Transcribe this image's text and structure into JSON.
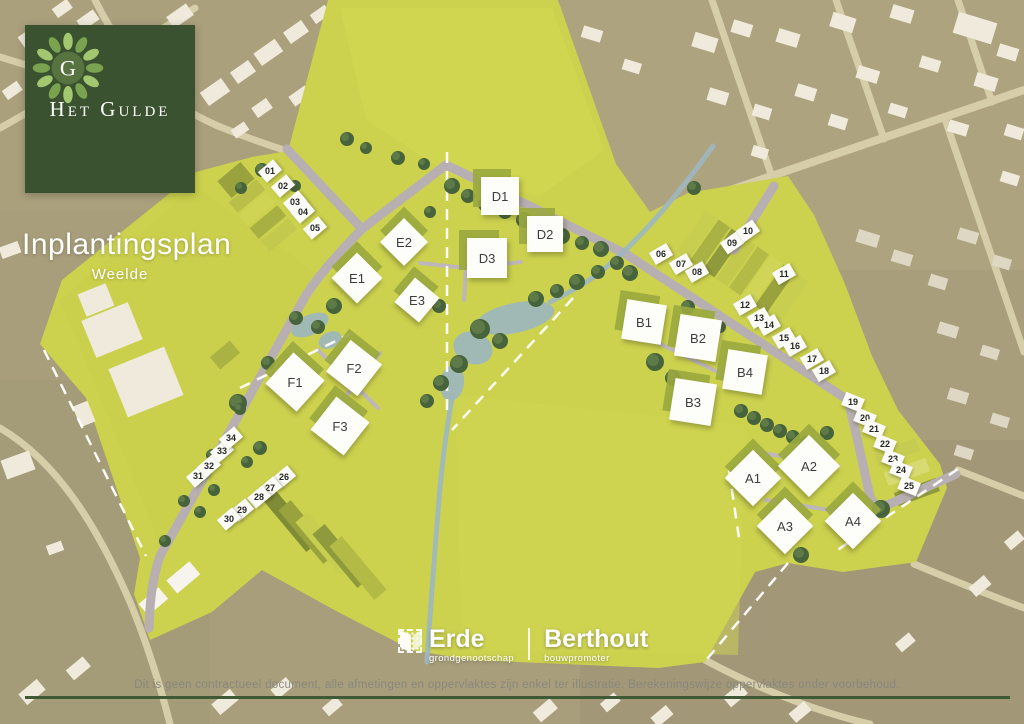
{
  "brand": {
    "monogram": "G",
    "name": "Het Gulde"
  },
  "title": {
    "main": "Inplantingsplan",
    "sub": "Weelde"
  },
  "partners": {
    "erde": {
      "name": "Erde",
      "tagline": "grondgenootschap"
    },
    "berthout": {
      "name": "Berthout",
      "tagline": "bouwpromoter"
    }
  },
  "footer": {
    "disclaimer": "Dit is geen contractueel document, alle afmetingen en oppervlaktes zijn enkel ter illustratie. Berekeningswijze oppervlaktes onder voorbehoud."
  },
  "colors": {
    "brand_green": "#3a5230",
    "site_yellow": "#ccd24e",
    "road_gray": "#b7afb1",
    "water_blue": "#9db7c0",
    "tree_green": "#47633b"
  },
  "map": {
    "blocks": [
      {
        "label": "E1",
        "x": 357,
        "y": 278,
        "size": 36,
        "rot": 45
      },
      {
        "label": "E2",
        "x": 404,
        "y": 242,
        "size": 34,
        "rot": 45
      },
      {
        "label": "E3",
        "x": 417,
        "y": 300,
        "size": 32,
        "rot": 40
      },
      {
        "label": "D1",
        "x": 500,
        "y": 196,
        "size": 38,
        "rot": 0
      },
      {
        "label": "D2",
        "x": 545,
        "y": 234,
        "size": 36,
        "rot": 0
      },
      {
        "label": "D3",
        "x": 487,
        "y": 258,
        "size": 40,
        "rot": 0
      },
      {
        "label": "F1",
        "x": 295,
        "y": 382,
        "size": 42,
        "rot": 42
      },
      {
        "label": "F2",
        "x": 354,
        "y": 368,
        "size": 40,
        "rot": 38
      },
      {
        "label": "F3",
        "x": 340,
        "y": 426,
        "size": 42,
        "rot": 38
      },
      {
        "label": "B1",
        "x": 644,
        "y": 322,
        "size": 40,
        "rot": 9
      },
      {
        "label": "B2",
        "x": 698,
        "y": 338,
        "size": 42,
        "rot": 9
      },
      {
        "label": "B4",
        "x": 745,
        "y": 372,
        "size": 40,
        "rot": 9
      },
      {
        "label": "B3",
        "x": 693,
        "y": 402,
        "size": 42,
        "rot": 9
      },
      {
        "label": "A1",
        "x": 753,
        "y": 478,
        "size": 40,
        "rot": 45
      },
      {
        "label": "A2",
        "x": 809,
        "y": 466,
        "size": 44,
        "rot": 45
      },
      {
        "label": "A3",
        "x": 785,
        "y": 526,
        "size": 40,
        "rot": 45
      },
      {
        "label": "A4",
        "x": 853,
        "y": 521,
        "size": 40,
        "rot": 45
      }
    ],
    "lots": [
      {
        "label": "01",
        "x": 270,
        "y": 171,
        "rot": -40
      },
      {
        "label": "02",
        "x": 283,
        "y": 186,
        "rot": -40
      },
      {
        "label": "03",
        "x": 295,
        "y": 202,
        "rot": -40
      },
      {
        "label": "04",
        "x": 303,
        "y": 212,
        "rot": -40
      },
      {
        "label": "05",
        "x": 315,
        "y": 228,
        "rot": -40
      },
      {
        "label": "06",
        "x": 661,
        "y": 254,
        "rot": -30
      },
      {
        "label": "07",
        "x": 681,
        "y": 264,
        "rot": -30
      },
      {
        "label": "08",
        "x": 697,
        "y": 272,
        "rot": -30
      },
      {
        "label": "09",
        "x": 732,
        "y": 243,
        "rot": -35
      },
      {
        "label": "10",
        "x": 748,
        "y": 231,
        "rot": -35
      },
      {
        "label": "11",
        "x": 784,
        "y": 274,
        "rot": -30
      },
      {
        "label": "12",
        "x": 745,
        "y": 305,
        "rot": -30
      },
      {
        "label": "13",
        "x": 759,
        "y": 318,
        "rot": -30
      },
      {
        "label": "14",
        "x": 769,
        "y": 325,
        "rot": -30
      },
      {
        "label": "15",
        "x": 784,
        "y": 338,
        "rot": -30
      },
      {
        "label": "16",
        "x": 795,
        "y": 346,
        "rot": -30
      },
      {
        "label": "17",
        "x": 812,
        "y": 359,
        "rot": -30
      },
      {
        "label": "18",
        "x": 824,
        "y": 371,
        "rot": -30
      },
      {
        "label": "19",
        "x": 853,
        "y": 402,
        "rot": 22
      },
      {
        "label": "20",
        "x": 865,
        "y": 418,
        "rot": 22
      },
      {
        "label": "21",
        "x": 874,
        "y": 429,
        "rot": 22
      },
      {
        "label": "22",
        "x": 885,
        "y": 444,
        "rot": 22
      },
      {
        "label": "23",
        "x": 893,
        "y": 459,
        "rot": 22
      },
      {
        "label": "24",
        "x": 901,
        "y": 470,
        "rot": 22
      },
      {
        "label": "25",
        "x": 909,
        "y": 486,
        "rot": 22
      },
      {
        "label": "26",
        "x": 284,
        "y": 477,
        "rot": -40
      },
      {
        "label": "27",
        "x": 270,
        "y": 488,
        "rot": -40
      },
      {
        "label": "28",
        "x": 259,
        "y": 497,
        "rot": -40
      },
      {
        "label": "29",
        "x": 242,
        "y": 510,
        "rot": -40
      },
      {
        "label": "30",
        "x": 229,
        "y": 519,
        "rot": -40
      },
      {
        "label": "31",
        "x": 198,
        "y": 476,
        "rot": -40
      },
      {
        "label": "32",
        "x": 209,
        "y": 466,
        "rot": -40
      },
      {
        "label": "33",
        "x": 222,
        "y": 451,
        "rot": -40
      },
      {
        "label": "34",
        "x": 231,
        "y": 438,
        "rot": -40
      }
    ]
  }
}
